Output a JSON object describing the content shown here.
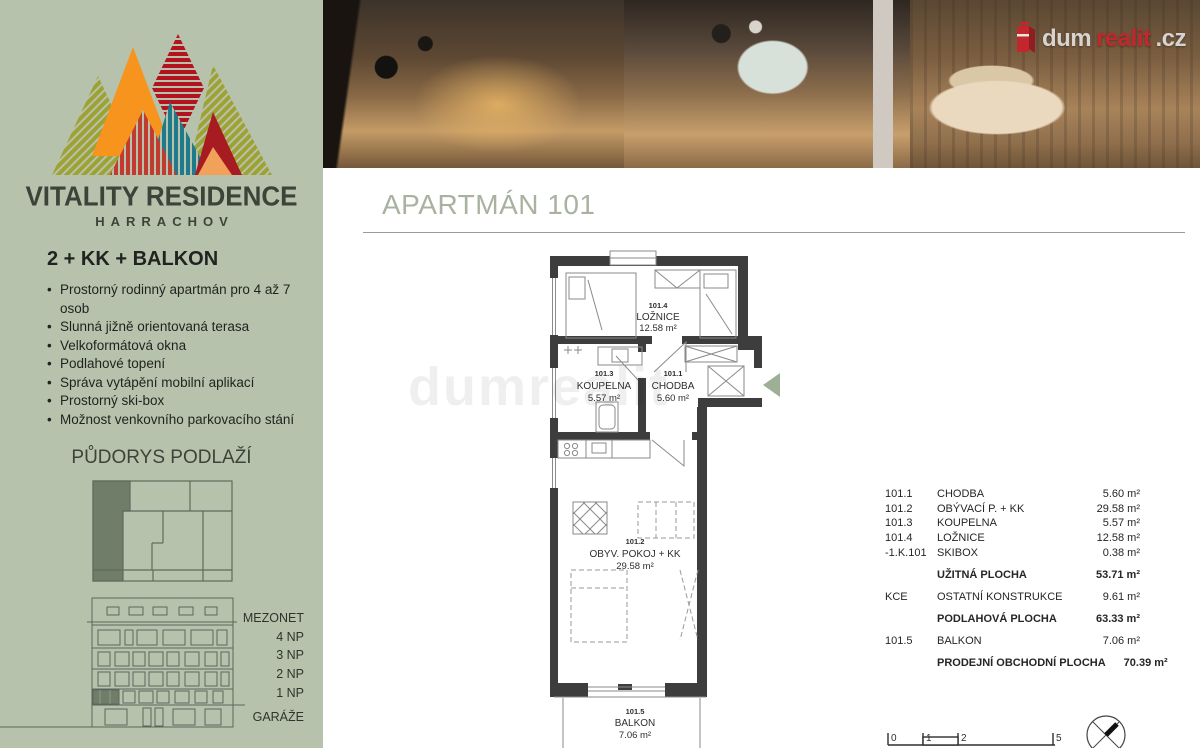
{
  "sidebar": {
    "brand_title": "VITALITY RESIDENCE",
    "brand_subtitle": "HARRACHOV",
    "unit_type": "2 + KK + BALKON",
    "features": [
      "Prostorný rodinný apartmán pro 4 až 7 osob",
      "Slunná jižně orientovaná terasa",
      "Velkoformátová okna",
      "Podlahové topení",
      "Správa vytápění mobilní aplikací",
      "Prostorný ski-box",
      "Možnost venkovního parkovacího stání"
    ],
    "floorplan_heading": "PŮDORYS PODLAŽÍ",
    "floor_labels": [
      "MEZONET",
      "4 NP",
      "3 NP",
      "2 NP",
      "1 NP",
      "GARÁŽE"
    ]
  },
  "header": {
    "title": "APARTMÁN 101"
  },
  "brand_logo": {
    "text_gray1": "dum",
    "text_red": "realit",
    "text_gray2": ".cz"
  },
  "plan": {
    "watermark": "dumrealit",
    "rooms": {
      "bedroom": {
        "id": "101.4",
        "name": "LOŽNICE",
        "area": "12.58 m²"
      },
      "bathroom": {
        "id": "101.3",
        "name": "KOUPELNA",
        "area": "5.57 m²"
      },
      "hall": {
        "id": "101.1",
        "name": "CHODBA",
        "area": "5.60 m²"
      },
      "living": {
        "id": "101.2",
        "name": "OBYV. POKOJ + KK",
        "area": "29.58 m²"
      },
      "balcony": {
        "id": "101.5",
        "name": "BALKON",
        "area": "7.06 m²"
      }
    }
  },
  "area_table": {
    "rows": [
      {
        "id": "101.1",
        "name": "CHODBA",
        "value": "5.60 m²",
        "bold": false,
        "gap": false
      },
      {
        "id": "101.2",
        "name": "OBÝVACÍ P. + KK",
        "value": "29.58 m²",
        "bold": false,
        "gap": false
      },
      {
        "id": "101.3",
        "name": "KOUPELNA",
        "value": "5.57 m²",
        "bold": false,
        "gap": false
      },
      {
        "id": "101.4",
        "name": "LOŽNICE",
        "value": "12.58 m²",
        "bold": false,
        "gap": false
      },
      {
        "id": "-1.K.101",
        "name": "SKIBOX",
        "value": "0.38 m²",
        "bold": false,
        "gap": false
      },
      {
        "id": "",
        "name": "UŽITNÁ PLOCHA",
        "value": "53.71 m²",
        "bold": true,
        "gap": true
      },
      {
        "id": "KCE",
        "name": "OSTATNÍ KONSTRUKCE",
        "value": "9.61 m²",
        "bold": false,
        "gap": true
      },
      {
        "id": "",
        "name": "PODLAHOVÁ PLOCHA",
        "value": "63.33 m²",
        "bold": true,
        "gap": true
      },
      {
        "id": "101.5",
        "name": "BALKON",
        "value": "7.06 m²",
        "bold": false,
        "gap": true
      },
      {
        "id": "",
        "name": "PRODEJNÍ  OBCHODNÍ PLOCHA",
        "value": "70.39 m²",
        "bold": true,
        "gap": true
      }
    ]
  },
  "scalebar": {
    "labels": [
      "0",
      "1",
      "2",
      "5"
    ]
  },
  "colors": {
    "sidebar_bg": "#b6c2ac",
    "accent_red": "#c1272d",
    "heading": "#a9b2a0",
    "wall": "#3d3d3d",
    "arrow_green": "#9db095",
    "highlight_unit": "#6f7d69"
  }
}
